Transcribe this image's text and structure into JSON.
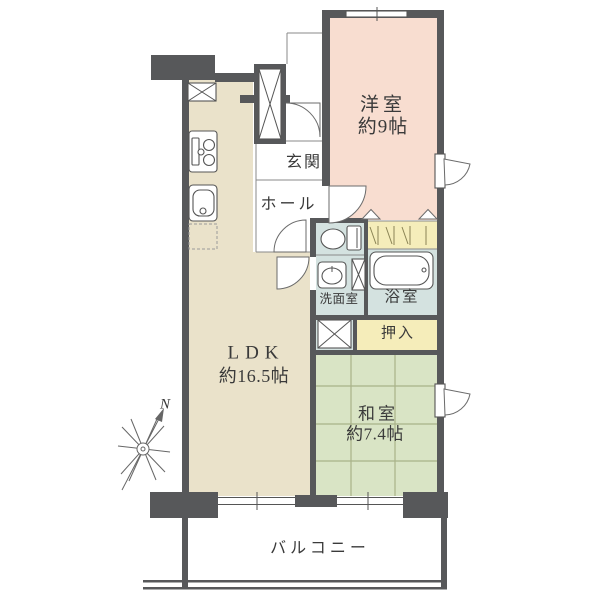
{
  "floorplan": {
    "rooms": {
      "western_room": {
        "name": "洋室",
        "size": "約9帖"
      },
      "ldk": {
        "name": "LDK",
        "size": "約16.5帖"
      },
      "japanese_room": {
        "name": "和室",
        "size": "約7.4帖"
      },
      "entrance": {
        "name": "玄関"
      },
      "hall": {
        "name": "ホール"
      },
      "washroom": {
        "name": "洗面室"
      },
      "bathroom": {
        "name": "浴室"
      },
      "oshiire": {
        "name": "押入"
      },
      "balcony": {
        "name": "バルコニー"
      }
    },
    "compass": {
      "north_label": "N"
    },
    "colors": {
      "wall": "#57585a",
      "western_room": "#f8ddd0",
      "ldk": "#eae2ca",
      "japanese_room": "#d9e4c5",
      "wet_area": "#d4e2e0",
      "closet": "#f5edba",
      "tatami_line": "#a9b289",
      "text": "#3a3a3a",
      "outline": "#666666"
    }
  }
}
